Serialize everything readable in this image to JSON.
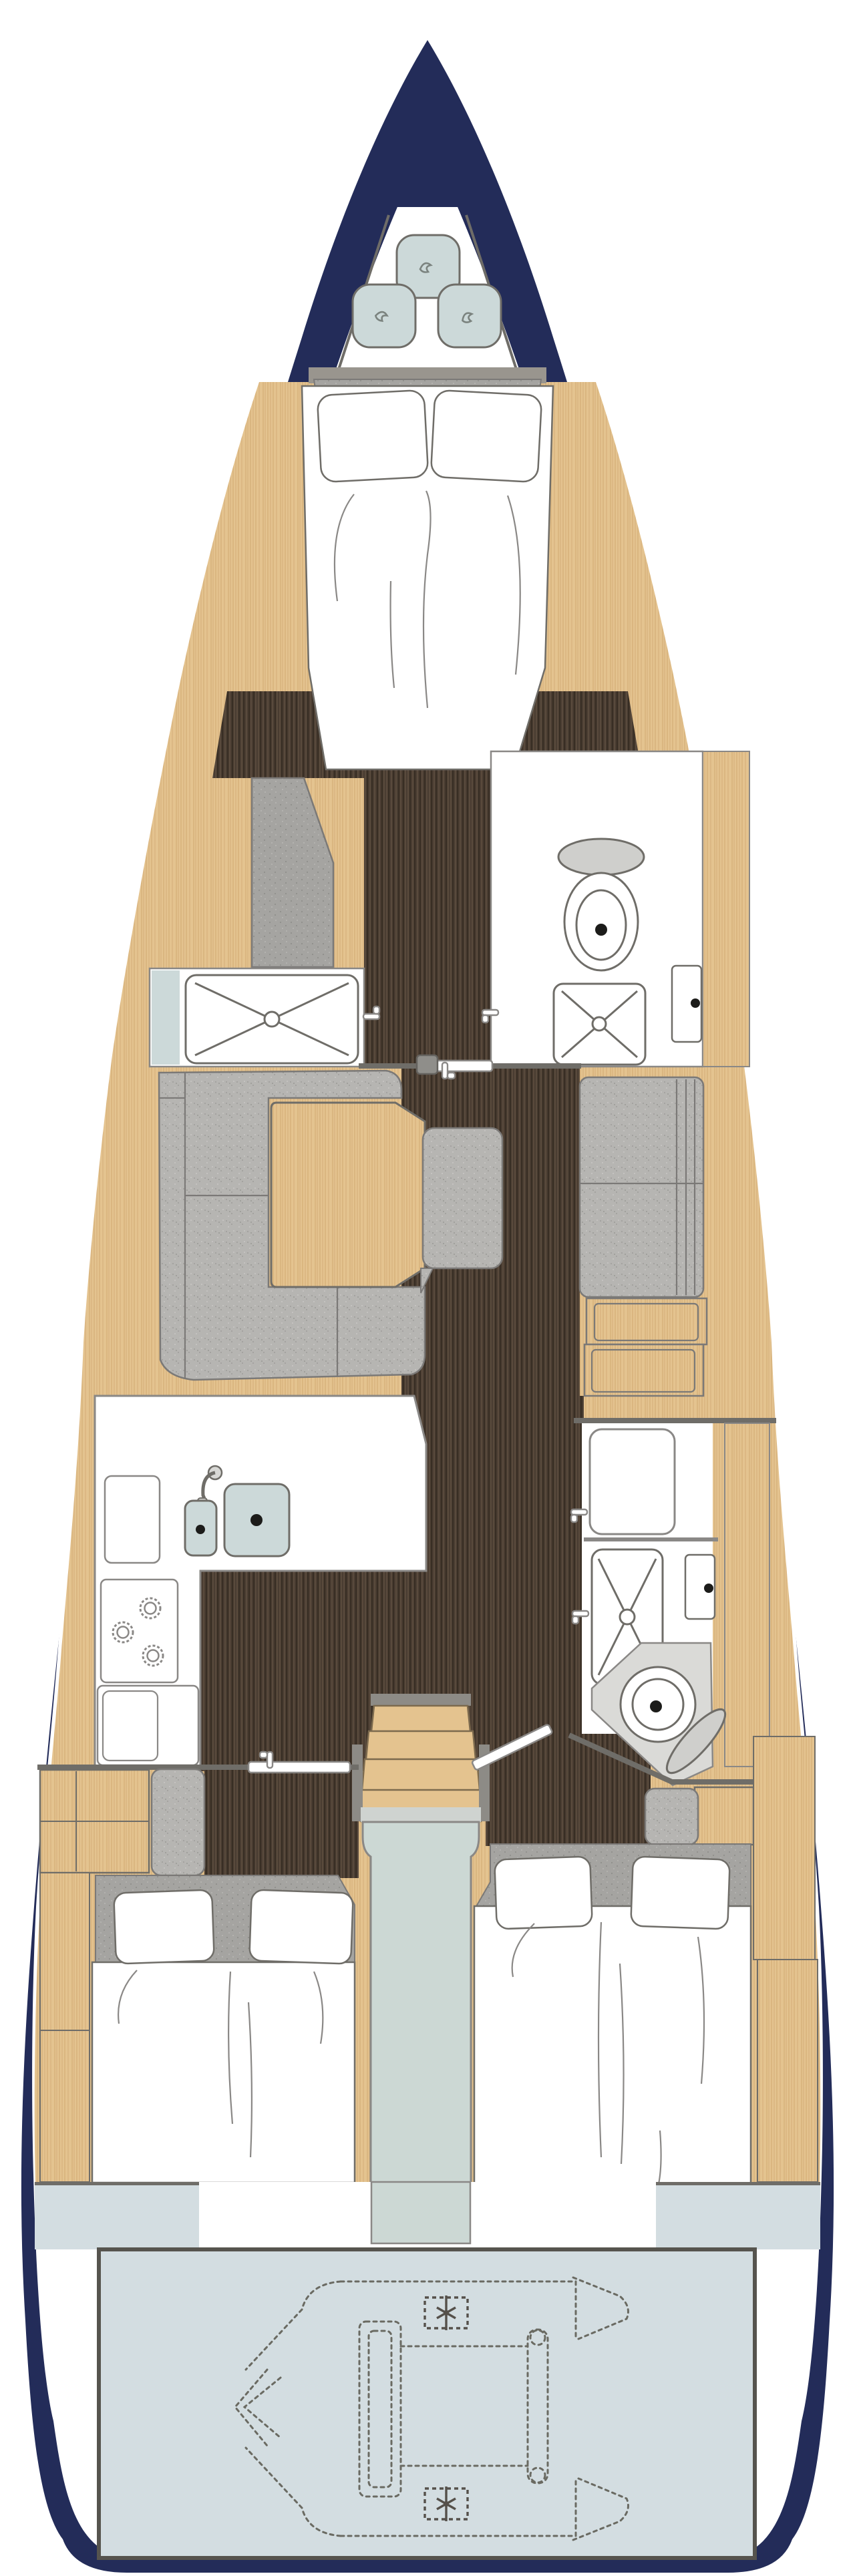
{
  "document": {
    "kind": "yacht-interior-floorplan",
    "orientation": "bow-up",
    "text_rendered_on_image": []
  },
  "colors": {
    "hull": "#232c59",
    "wood": "#e4c38f",
    "floor": "#483b30",
    "uph": "#b6b5b2",
    "uphd": "#a5a4a1",
    "aqua": "#ccd9d9",
    "steel": "#ccd8d4",
    "garage": "#d3dde1",
    "line": "#6f6d68",
    "dinghy": "#6a6a62"
  },
  "inventory": {
    "bow_locker": {
      "fenders": 3
    },
    "cabins": [
      {
        "id": "owner-cabin-forward",
        "beds": 1,
        "pillows": 2
      },
      {
        "id": "aft-cabin-port",
        "beds": 1,
        "pillows": 2
      },
      {
        "id": "aft-cabin-starboard",
        "beds": 1,
        "pillows": 2
      }
    ],
    "heads": [
      {
        "id": "forward-head-port",
        "fixtures": [
          "shower"
        ]
      },
      {
        "id": "forward-head-starboard",
        "fixtures": [
          "toilet",
          "shower",
          "sink"
        ]
      },
      {
        "id": "aft-head-starboard",
        "fixtures": [
          "vanity",
          "shower",
          "sink",
          "toilet"
        ]
      }
    ],
    "saloon": {
      "sofas": 2,
      "tables": 1,
      "island_seats": 1,
      "mast_step": 1
    },
    "galley": {
      "sinks": 2,
      "burners": 3,
      "faucets": 1
    },
    "companionway": {
      "steps": 4
    },
    "stern_garage": {
      "dinghy_outline": true,
      "propeller_icons": 2
    },
    "door_handles": 8
  }
}
